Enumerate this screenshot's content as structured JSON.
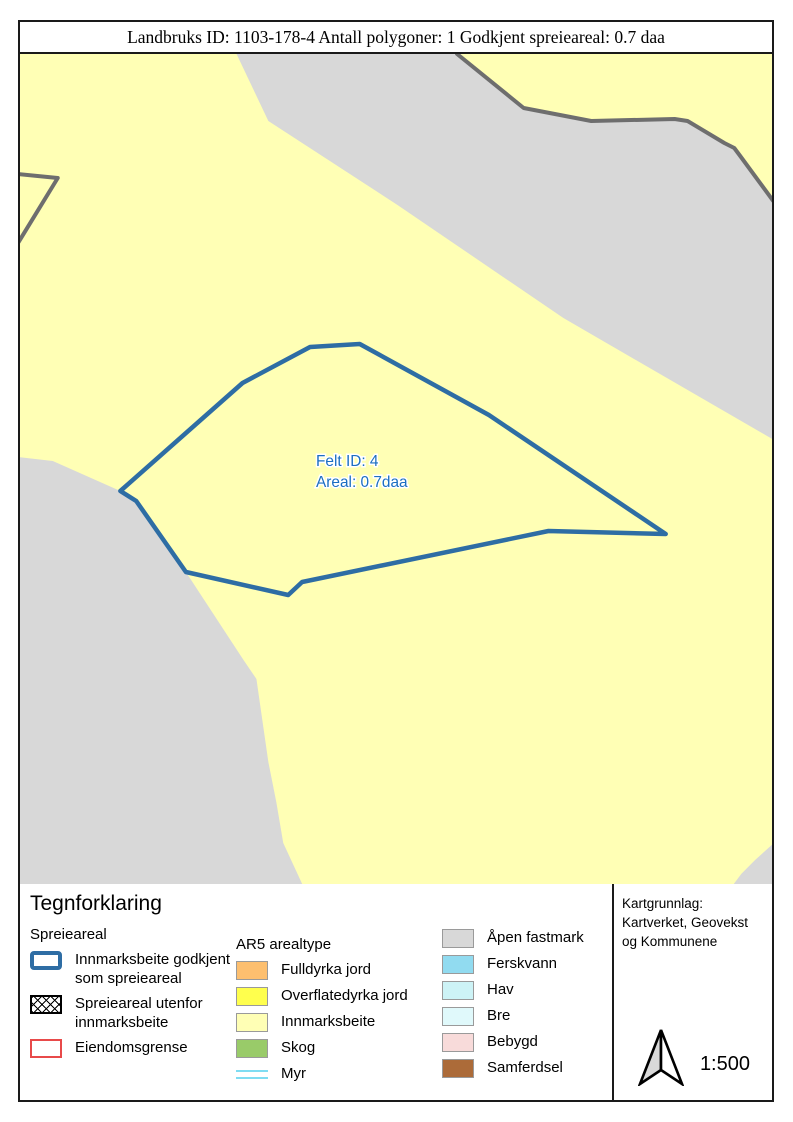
{
  "title_bar": {
    "text": "Landbruks ID: 1103-178-4 Antall polygoner: 1 Godkjent spreieareal: 0.7 daa"
  },
  "map": {
    "background_color": "#FFFFB5",
    "colors": {
      "yellow": "#FFFFB5",
      "gray": "#D8D8D8",
      "darkline": "#6E6E6E",
      "blue": "#2E6DA4",
      "label_blue": "#1B6EC2"
    },
    "feature_label": {
      "line1": "Felt ID: 4",
      "line2": "Areal: 0.7daa",
      "x": 316,
      "y": 466,
      "line_gap": 21
    },
    "features": [
      {
        "name": "open-land-band",
        "type": "polygon",
        "fill": "gray",
        "points": [
          [
            236,
            54
          ],
          [
            458,
            54
          ],
          [
            525,
            108
          ],
          [
            593,
            121
          ],
          [
            677,
            119
          ],
          [
            690,
            121
          ],
          [
            727,
            143
          ],
          [
            737,
            148
          ],
          [
            743,
            156
          ],
          [
            777,
            202
          ],
          [
            777,
            440
          ],
          [
            565,
            318
          ],
          [
            398,
            205
          ],
          [
            268,
            121
          ]
        ]
      },
      {
        "name": "band-border-line",
        "type": "polyline",
        "stroke": "darkline",
        "width": 4,
        "points": [
          [
            458,
            54
          ],
          [
            525,
            108
          ],
          [
            593,
            121
          ],
          [
            677,
            119
          ],
          [
            690,
            121
          ],
          [
            727,
            143
          ],
          [
            737,
            148
          ],
          [
            743,
            156
          ],
          [
            777,
            202
          ]
        ]
      },
      {
        "name": "west-boundary-line",
        "type": "polyline",
        "stroke": "darkline",
        "width": 4,
        "points": [
          [
            16,
            174
          ],
          [
            56,
            178
          ],
          [
            16,
            243
          ]
        ]
      },
      {
        "name": "open-land-southwest",
        "type": "polygon",
        "fill": "gray",
        "points": [
          [
            16,
            457
          ],
          [
            51,
            461
          ],
          [
            119,
            491
          ],
          [
            137,
            504
          ],
          [
            185,
            572
          ],
          [
            243,
            660
          ],
          [
            256,
            679
          ],
          [
            268,
            762
          ],
          [
            276,
            802
          ],
          [
            283,
            843
          ],
          [
            303,
            886
          ],
          [
            16,
            886
          ]
        ]
      },
      {
        "name": "open-land-southeast",
        "type": "polygon",
        "fill": "gray",
        "points": [
          [
            777,
            843
          ],
          [
            777,
            886
          ],
          [
            735,
            886
          ],
          [
            744,
            874
          ],
          [
            758,
            860
          ]
        ]
      },
      {
        "name": "spreieareal-polygon",
        "type": "polygon",
        "fill": "none",
        "stroke": "blue",
        "width": 4.5,
        "points": [
          [
            119,
            491
          ],
          [
            242,
            383
          ],
          [
            310,
            347
          ],
          [
            360,
            344
          ],
          [
            490,
            415
          ],
          [
            668,
            534
          ],
          [
            550,
            531
          ],
          [
            302,
            582
          ],
          [
            288,
            595
          ],
          [
            185,
            572
          ],
          [
            135,
            501
          ]
        ]
      }
    ]
  },
  "legend": {
    "title": "Tegnforklaring",
    "groups": [
      {
        "heading": "Spreieareal",
        "items": [
          {
            "symbol": "outline-blue",
            "label": "Innmarksbeite godkjent\nsom spreieareal"
          },
          {
            "symbol": "crosshatch",
            "label": "Spreieareal utenfor\ninnmarksbeite"
          },
          {
            "symbol": "outline-red",
            "label": "Eiendomsgrense"
          }
        ]
      },
      {
        "heading": "AR5 arealtype",
        "items": [
          {
            "symbol": "swatch",
            "color": "#FDBF6F",
            "label": "Fulldyrka jord"
          },
          {
            "symbol": "swatch",
            "color": "#FFFF4D",
            "label": "Overflatedyrka jord"
          },
          {
            "symbol": "swatch",
            "color": "#FFFFB5",
            "label": "Innmarksbeite"
          },
          {
            "symbol": "swatch",
            "color": "#99CB69",
            "label": "Skog"
          },
          {
            "symbol": "myr",
            "color": "#7FDCF2",
            "label": "Myr"
          }
        ]
      },
      {
        "heading": "",
        "items": [
          {
            "symbol": "swatch",
            "color": "#D8D8D8",
            "label": "Åpen fastmark"
          },
          {
            "symbol": "swatch",
            "color": "#91DBF0",
            "label": "Ferskvann"
          },
          {
            "symbol": "swatch",
            "color": "#CDF3F6",
            "label": "Hav"
          },
          {
            "symbol": "swatch",
            "color": "#E0F9FB",
            "label": "Bre"
          },
          {
            "symbol": "swatch",
            "color": "#F8DBDA",
            "label": "Bebygd"
          },
          {
            "symbol": "swatch",
            "color": "#AC6B39",
            "label": "Samferdsel"
          }
        ]
      }
    ]
  },
  "info_box": {
    "lines": [
      "Kartgrunnlag:",
      "Kartverket, Geovekst",
      "og Kommunene"
    ],
    "scale_label": "1:500"
  }
}
